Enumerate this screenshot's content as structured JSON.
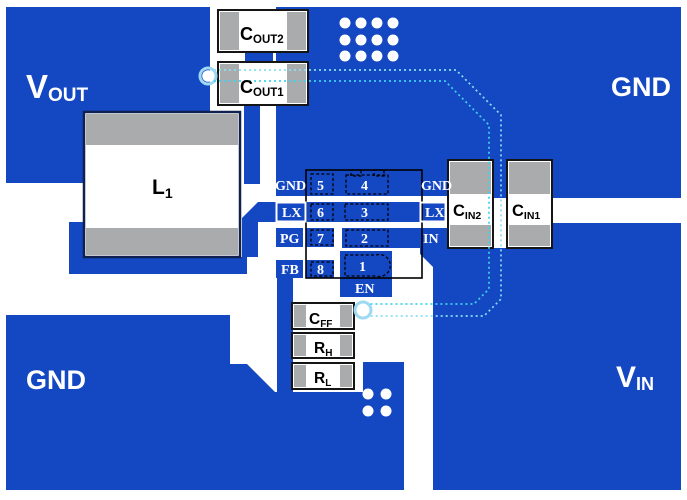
{
  "colors": {
    "copper_blue": "#1447C2",
    "pad_gray": "#A9ABAD",
    "component_body_white": "#FFFFFF",
    "bottom_trace_cyan": "#3FD2EF",
    "bottom_trace_cyan_pale": "#8ADFF4",
    "silkscreen_black": "#111111",
    "net_label_white": "#FFFFFF"
  },
  "net_labels": {
    "vout": {
      "main": "V",
      "sub": "OUT"
    },
    "gnd_top_right": "GND",
    "gnd_bottom_left": "GND",
    "vin": {
      "main": "V",
      "sub": "IN"
    }
  },
  "components": {
    "cout2": {
      "main": "C",
      "sub": "OUT2"
    },
    "cout1": {
      "main": "C",
      "sub": "OUT1"
    },
    "l1": {
      "main": "L",
      "sub": "1"
    },
    "cin2": {
      "main": "C",
      "sub": "IN2"
    },
    "cin1": {
      "main": "C",
      "sub": "IN1"
    },
    "cff": {
      "main": "C",
      "sub": "FF"
    },
    "rh": {
      "main": "R",
      "sub": "H"
    },
    "rl": {
      "main": "R",
      "sub": "L"
    }
  },
  "ic_pins": {
    "pin5": {
      "number": "5",
      "label": "GND"
    },
    "pin6": {
      "number": "6",
      "label": "LX"
    },
    "pin7": {
      "number": "7",
      "label": "PG"
    },
    "pin8": {
      "number": "8",
      "label": "FB"
    },
    "pin4": {
      "number": "4",
      "label": "GND"
    },
    "pin3": {
      "number": "3",
      "label": "LX"
    },
    "pin2": {
      "number": "2",
      "label": "IN"
    },
    "pin1": {
      "number": "1",
      "label": "EN"
    }
  }
}
